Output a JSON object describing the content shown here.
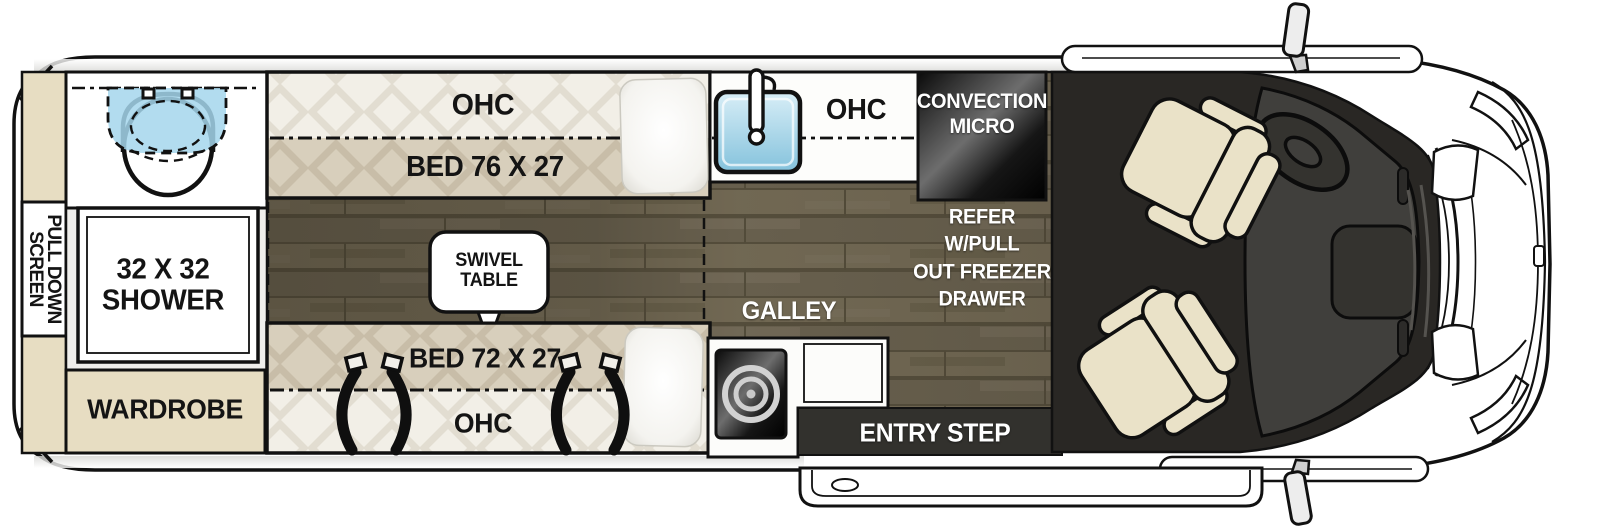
{
  "title": "Camper van floor plan",
  "labels": {
    "pull_down_screen": [
      "PULL DOWN",
      "SCREEN"
    ],
    "shower": [
      "32 X 32",
      "SHOWER"
    ],
    "wardrobe": "WARDROBE",
    "ohc_front": "OHC",
    "bed_front": "BED 76 X 27",
    "swivel_table": [
      "SWIVEL",
      "TABLE"
    ],
    "ohc_galley": "OHC",
    "convection_micro": [
      "CONVECTION",
      "MICRO"
    ],
    "refrigerator": [
      "REFER",
      "W/PULL",
      "OUT FREEZER",
      "DRAWER"
    ],
    "galley": "GALLEY",
    "bed_rear": "BED 72 X 27",
    "ohc_rear": "OHC",
    "entry_step": "ENTRY STEP"
  },
  "colors": {
    "cabinet_tan": "#e7ddc2",
    "bed_tan": "#d8cfbc",
    "quilt_white": "#f2efe7",
    "wood_floor": "#6f6753",
    "water_blue": "#a5d6ec",
    "sink_blue": "#9fd0e5",
    "entry_step_dark": "#32312d",
    "cab_floor": "#292724",
    "dashboard_gray": "#403f3c",
    "seat_cream": "#eae2c8",
    "outline_black": "#111111",
    "label_black": "#141414",
    "label_white": "#ffffff"
  }
}
